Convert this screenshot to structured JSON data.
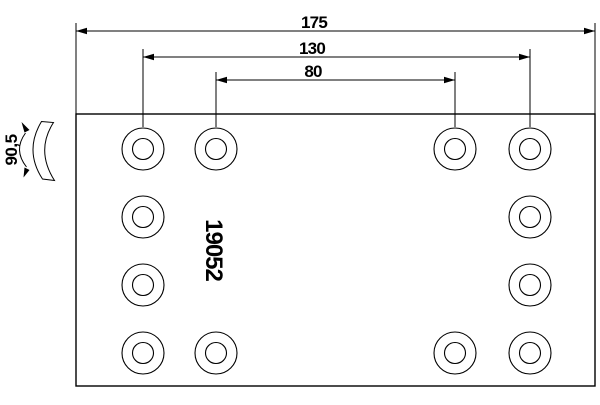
{
  "drawing": {
    "type": "technical-drawing-brake-lining",
    "part_number": "19052",
    "dimensions": [
      {
        "name": "overall-length",
        "value": "175"
      },
      {
        "name": "hole-spacing-outer",
        "value": "130"
      },
      {
        "name": "hole-spacing-inner",
        "value": "80"
      }
    ],
    "arc_dimension": {
      "name": "arc-width",
      "value": "90,5"
    },
    "colors": {
      "background": "#ffffff",
      "line": "#000000"
    },
    "holes": {
      "rows_y": [
        149,
        217,
        285,
        353
      ],
      "cols_x": [
        143,
        216,
        455,
        530
      ],
      "pattern": [
        [
          1,
          1,
          1,
          1
        ],
        [
          1,
          0,
          0,
          1
        ],
        [
          1,
          0,
          0,
          1
        ],
        [
          1,
          1,
          1,
          1
        ]
      ],
      "outer_radius": 21,
      "inner_radius": 10.5
    }
  }
}
